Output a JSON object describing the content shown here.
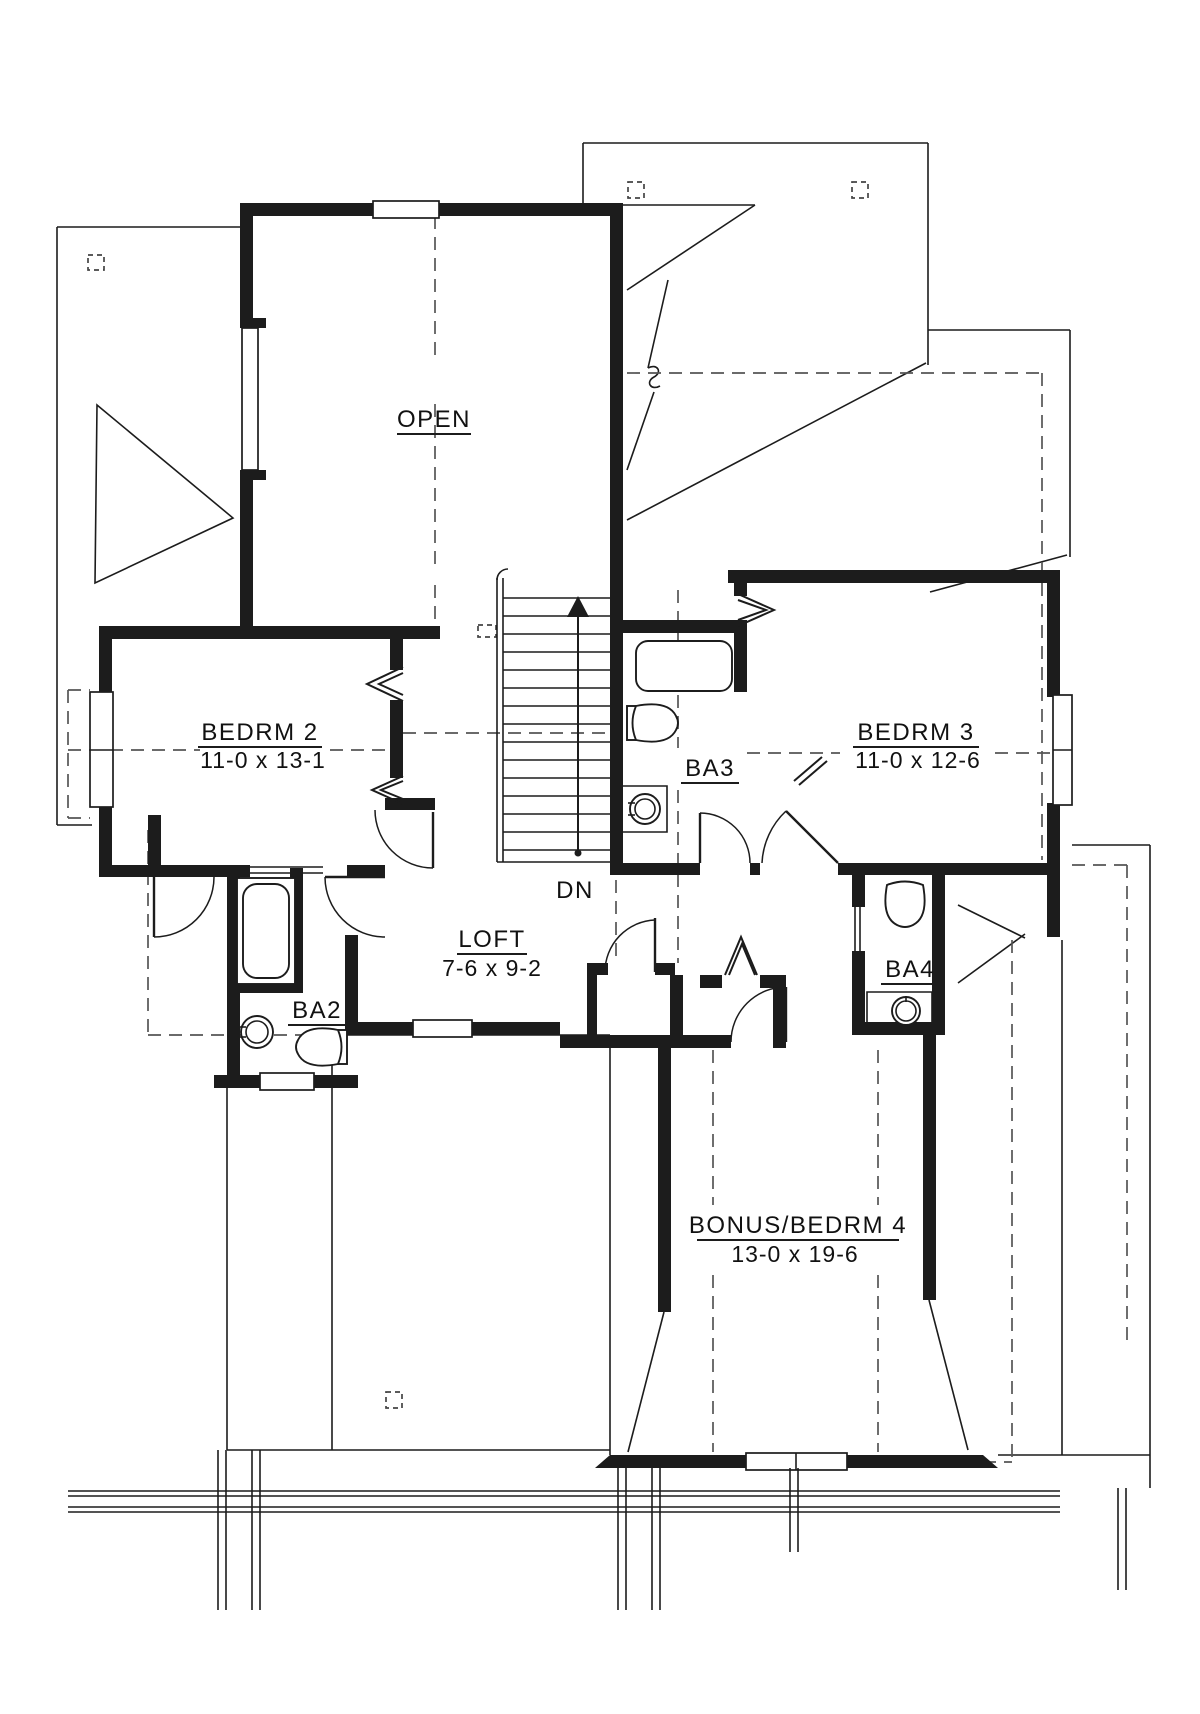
{
  "colors": {
    "ink": "#1c1c1c",
    "paper": "#ffffff",
    "dashed_line": "#555555"
  },
  "labels": {
    "open": "OPEN",
    "bedrm2_name": "BEDRM 2",
    "bedrm2_dims": "11-0 x 13-1",
    "bedrm3_name": "BEDRM 3",
    "bedrm3_dims": "11-0 x 12-6",
    "ba2": "BA2",
    "ba3": "BA3",
    "ba4": "BA4",
    "loft_name": "LOFT",
    "loft_dims": "7-6 x 9-2",
    "bonus_name": "BONUS/BEDRM 4",
    "bonus_dims": "13-0 x 19-6",
    "stairs_down": "DN"
  }
}
